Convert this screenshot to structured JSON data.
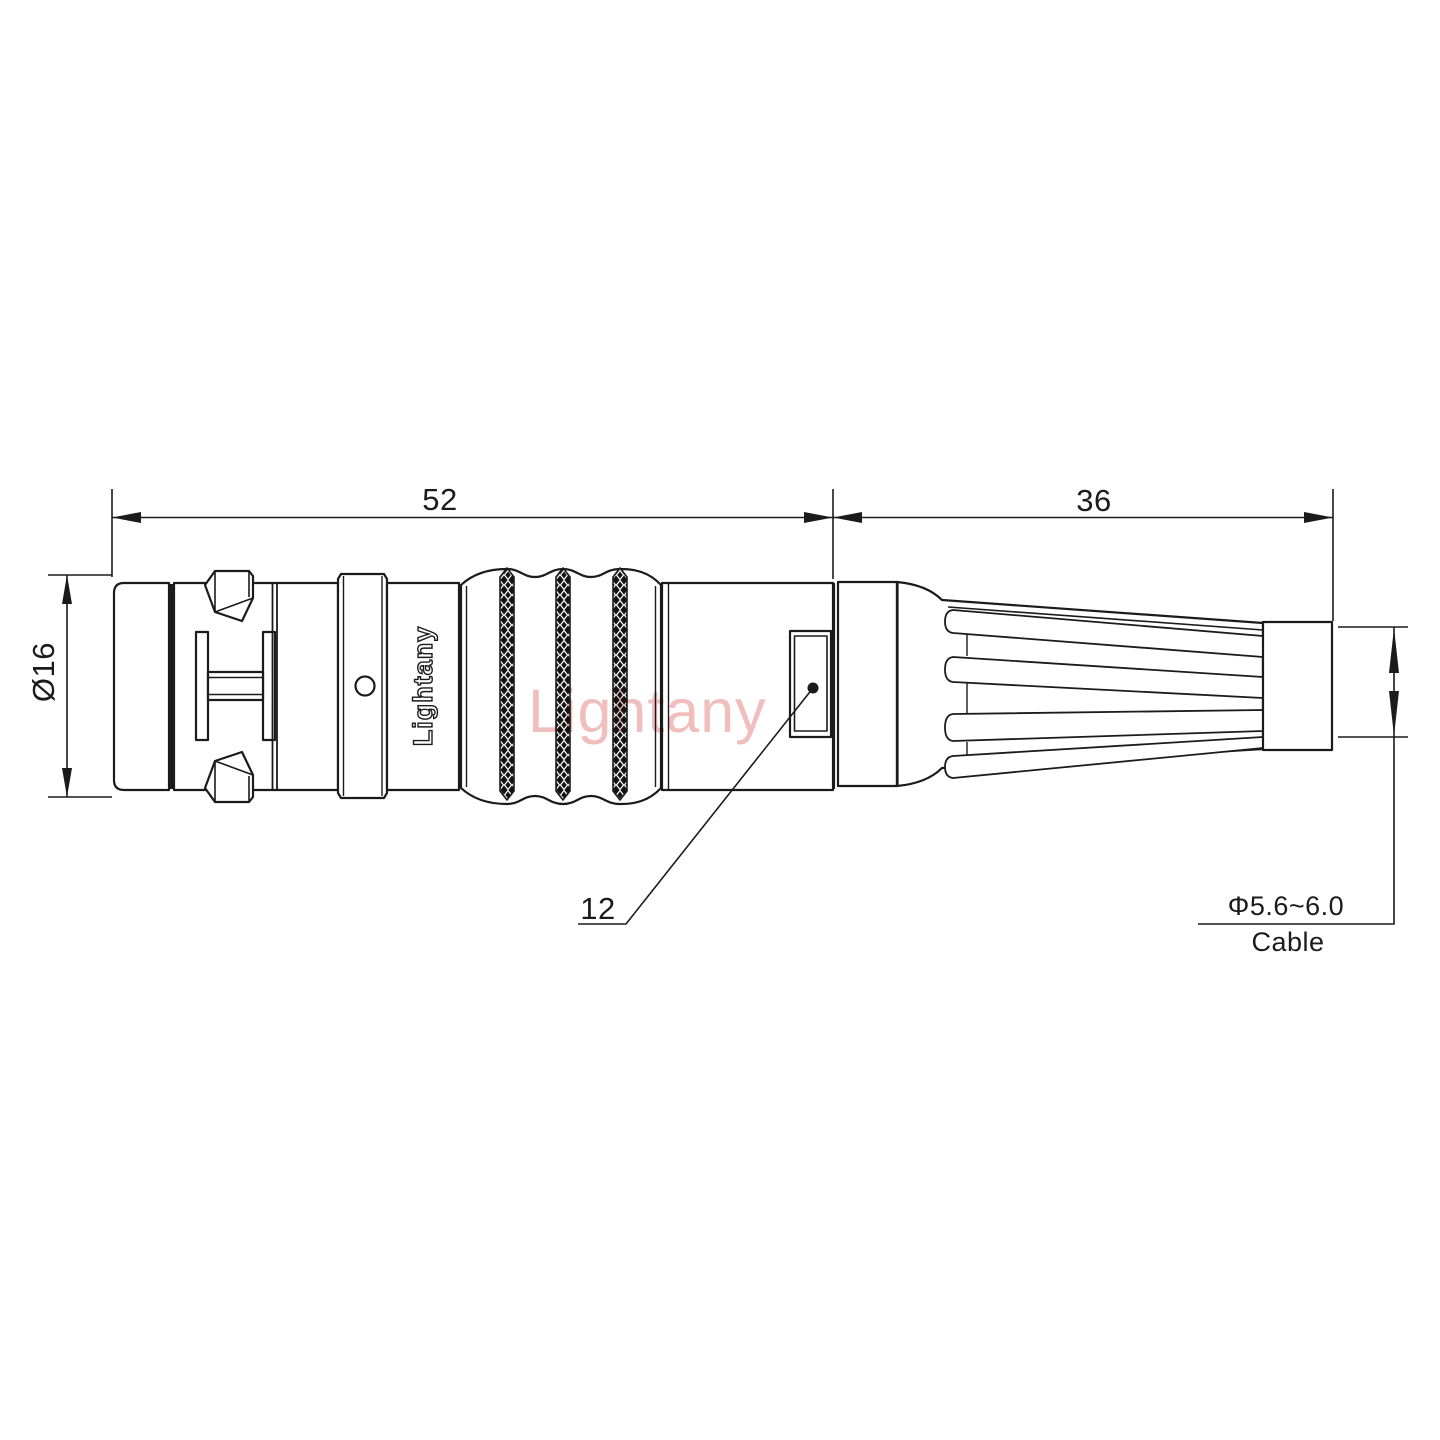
{
  "drawing": {
    "type": "technical-dimension-drawing",
    "subject": "Circular push-pull connector plug with bend relief, side view",
    "background": "#ffffff",
    "line_color": "#1b1b1b",
    "watermark": {
      "text": "Lightany",
      "color": "#eeaeae"
    },
    "branding": {
      "body_engraving": "Lightany"
    },
    "dimensions": {
      "front_length": "52",
      "rear_length": "36",
      "front_diameter": "Ø16",
      "release_sleeve_width": "12",
      "cable_diameter": "Φ5.6~6.0",
      "cable_label": "Cable"
    }
  }
}
